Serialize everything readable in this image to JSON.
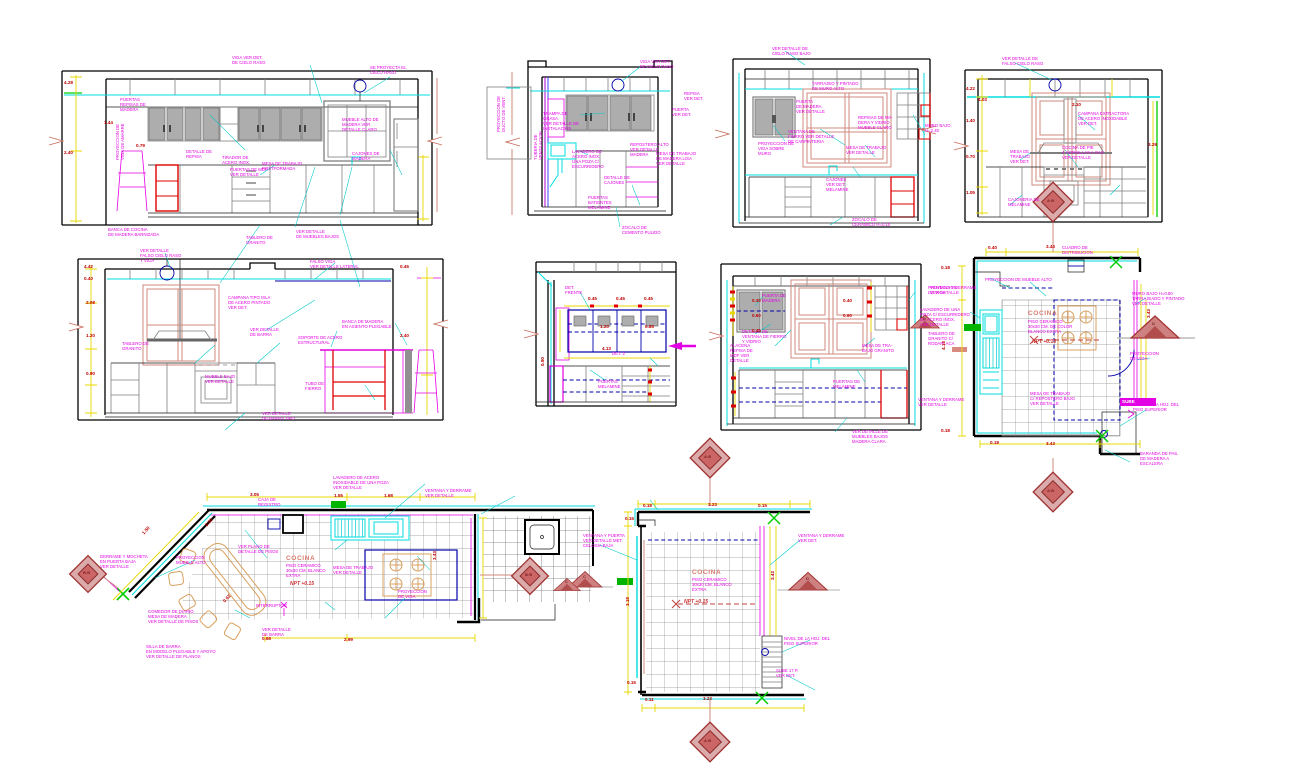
{
  "sheet": {
    "background": "#ffffff"
  },
  "colors": {
    "annotation": "#e400e4",
    "dimension": "#c00000",
    "linework_cyan": "#00dede",
    "dim_line_yellow": "#e8d800",
    "accent_red": "#e00000",
    "hidden_navy": "#0000a8",
    "window_salmon": "#d08a7e",
    "marker_darkred": "#a03030",
    "cabinet_gray": "#adadad",
    "green": "#00cc00",
    "stove_tan": "#d9a05f"
  },
  "annotations": [
    {
      "x": 232,
      "y": 56,
      "t": "VIGA VER DET.\nDE CIELO RASO"
    },
    {
      "x": 370,
      "y": 66,
      "t": "SE PROYECTA EL\nCIELO RASO"
    },
    {
      "x": 120,
      "y": 98,
      "t": "PUERTAS\nREPISAS DE\nMADERA"
    },
    {
      "x": 116,
      "y": 160,
      "r": -90,
      "t": "PROYECCION DE\nVIGA DE AMARRE"
    },
    {
      "x": 186,
      "y": 150,
      "t": "DETALLE DE\nREPISA"
    },
    {
      "x": 222,
      "y": 156,
      "t": "TIRADOR DE\nACERO INOX."
    },
    {
      "x": 230,
      "y": 168,
      "t": "PUERTAS DE MDF\nVER DETALLE"
    },
    {
      "x": 262,
      "y": 162,
      "t": "MESA DE TRABAJO\nPOSTFORMADA"
    },
    {
      "x": 352,
      "y": 152,
      "t": "CAJONES DE\nMADERA"
    },
    {
      "x": 342,
      "y": 118,
      "t": "MUEBLE ALTO DE\nMADERA VER\nDETALLE CLARO"
    },
    {
      "x": 108,
      "y": 228,
      "t": "BANCA DE COCINA\nDE MADERA BARNIZADA"
    },
    {
      "x": 296,
      "y": 230,
      "t": "VER DETALLE\nDE MUEBLES BAJOS"
    },
    {
      "x": 246,
      "y": 236,
      "t": "TABLERO DE\nGRANITO"
    },
    {
      "x": 64,
      "y": 80,
      "c": "d",
      "t": "4.28"
    },
    {
      "x": 64,
      "y": 150,
      "c": "d",
      "t": "2.40"
    },
    {
      "x": 136,
      "y": 143,
      "c": "d",
      "t": "0.79"
    },
    {
      "x": 104,
      "y": 120,
      "c": "d",
      "t": "1.44"
    },
    {
      "x": 640,
      "y": 60,
      "t": "VIGA VER DET.\nDE CIELO RASO"
    },
    {
      "x": 684,
      "y": 92,
      "t": "REPISA\nVER DET."
    },
    {
      "x": 543,
      "y": 112,
      "t": "TRAMPA DE\nGRASA\nVER DETALLE DE\nINSTALACION"
    },
    {
      "x": 672,
      "y": 108,
      "t": "PUERTA\nVER DET."
    },
    {
      "x": 572,
      "y": 150,
      "t": "LAVADERO DE\nACERO INOX.\nUNA POZA C/\nESCURRIDERO"
    },
    {
      "x": 630,
      "y": 143,
      "t": "REPOSTERO ALTO\nVER DETALLE\nMADERA"
    },
    {
      "x": 656,
      "y": 152,
      "t": "MESA DE TRABAJO\nDE MADERA LISA\nVER DETALLE"
    },
    {
      "x": 604,
      "y": 176,
      "t": "DETALLE DE\nCAJONES"
    },
    {
      "x": 588,
      "y": 196,
      "t": "PUERTAS\nBATIENTES\nMELAMINE"
    },
    {
      "x": 622,
      "y": 226,
      "t": "ZOCALO DE\nCEMENTO PULIDO"
    },
    {
      "x": 534,
      "y": 160,
      "r": -90,
      "t": "TUBERIA DE\nVENTILACION"
    },
    {
      "x": 772,
      "y": 47,
      "t": "VER DETALLE DE\nCIELO RASO BAJO"
    },
    {
      "x": 812,
      "y": 82,
      "t": "TARRAJEO Y PINTADO\nDE MURO ALTO"
    },
    {
      "x": 796,
      "y": 100,
      "t": "PUERTA\nDE MADERA\nVER DETALLE"
    },
    {
      "x": 858,
      "y": 116,
      "t": "REPISAS DE MA-\nDERA Y VIDRIO\nMUEBLE CLARO"
    },
    {
      "x": 788,
      "y": 130,
      "t": "VENTANA DE\nFIERRO VER DETALLE\nDE CARPINTERIA"
    },
    {
      "x": 758,
      "y": 142,
      "t": "PROYECCION DE\nVIGA SOBRE\nMURO"
    },
    {
      "x": 846,
      "y": 146,
      "t": "MESA DE TRABAJO\nVER DETALLE"
    },
    {
      "x": 826,
      "y": 178,
      "t": "CAJONES\nVER DET.\nMELAMINE"
    },
    {
      "x": 852,
      "y": 218,
      "t": "ZOCALO DE\nCERAMICO H=0.10"
    },
    {
      "x": 925,
      "y": 124,
      "t": "MURO BAJO\nH=2.40"
    },
    {
      "x": 1002,
      "y": 57,
      "t": "VER DETALLE DE\nFALSO CIELO RASO"
    },
    {
      "x": 1078,
      "y": 112,
      "t": "CAMPANA EXTRACTORA\nDE ACERO INOXIDABLE\nVER DET."
    },
    {
      "x": 1010,
      "y": 150,
      "t": "MESA DE\nTRABAJO\nVER DET."
    },
    {
      "x": 1062,
      "y": 146,
      "t": "COCINA DE PIE\n4 HORNILLAS A GAS\nVER DETALLE"
    },
    {
      "x": 1008,
      "y": 198,
      "t": "CAJONERIA DE\nMELAMINE"
    },
    {
      "x": 966,
      "y": 86,
      "c": "d",
      "t": "4.22"
    },
    {
      "x": 978,
      "y": 97,
      "c": "d",
      "t": "4.03"
    },
    {
      "x": 966,
      "y": 118,
      "c": "d",
      "t": "1.40"
    },
    {
      "x": 966,
      "y": 154,
      "c": "d",
      "t": "0.70"
    },
    {
      "x": 966,
      "y": 190,
      "c": "d",
      "t": "1.05"
    },
    {
      "x": 1072,
      "y": 102,
      "c": "d",
      "t": "2.10"
    },
    {
      "x": 1148,
      "y": 142,
      "c": "d",
      "t": "3.29"
    },
    {
      "x": 140,
      "y": 249,
      "t": "VER DETALLE\nFALSO CIELO RASO\nY VIGA"
    },
    {
      "x": 310,
      "y": 260,
      "t": "FALSO VIGA\nVER DETALLE LATERAL"
    },
    {
      "x": 228,
      "y": 296,
      "t": "CAMPANA TIPO ISLA\nDE ACERO PINTADO\nVER DET."
    },
    {
      "x": 250,
      "y": 328,
      "t": "VER DETALLE\nDE BARRA"
    },
    {
      "x": 298,
      "y": 336,
      "t": "SOPORTE DE ACERO\nESTRUCTURAL"
    },
    {
      "x": 342,
      "y": 320,
      "t": "BANCA DE MADERA\nEN ASIENTO PLEGABLE"
    },
    {
      "x": 122,
      "y": 342,
      "t": "TABLERO DE\nGRANITO"
    },
    {
      "x": 205,
      "y": 375,
      "t": "MUEBLE BAJO\nVER DETALLE"
    },
    {
      "x": 305,
      "y": 382,
      "t": "TUBO DE\nFIERRO"
    },
    {
      "x": 262,
      "y": 412,
      "t": "VER DETALLE\nDE BARRA TIPO"
    },
    {
      "x": 84,
      "y": 264,
      "c": "d",
      "t": "4.42"
    },
    {
      "x": 84,
      "y": 276,
      "c": "d",
      "t": "0.40"
    },
    {
      "x": 86,
      "y": 300,
      "c": "d",
      "t": "2.08"
    },
    {
      "x": 86,
      "y": 333,
      "c": "d",
      "t": "1.20"
    },
    {
      "x": 86,
      "y": 371,
      "c": "d",
      "t": "0.90"
    },
    {
      "x": 400,
      "y": 264,
      "c": "d",
      "t": "0.45"
    },
    {
      "x": 400,
      "y": 333,
      "c": "d",
      "t": "2.40"
    },
    {
      "x": 565,
      "y": 286,
      "t": "DET.\nFRENTE"
    },
    {
      "x": 612,
      "y": 352,
      "t": "DET. 2"
    },
    {
      "x": 598,
      "y": 380,
      "t": "PUERTAS\nMELAMINE"
    },
    {
      "x": 588,
      "y": 296,
      "c": "d",
      "t": "0.45"
    },
    {
      "x": 616,
      "y": 296,
      "c": "d",
      "t": "0.45"
    },
    {
      "x": 644,
      "y": 296,
      "c": "d",
      "t": "0.45"
    },
    {
      "x": 600,
      "y": 324,
      "c": "d",
      "t": "1.20"
    },
    {
      "x": 645,
      "y": 324,
      "c": "d",
      "t": "0.85"
    },
    {
      "x": 602,
      "y": 346,
      "c": "d",
      "t": "4.13"
    },
    {
      "x": 540,
      "y": 366,
      "r": -90,
      "c": "d",
      "t": "0.90"
    },
    {
      "x": 762,
      "y": 294,
      "t": "PUERTA DE\nMADERA"
    },
    {
      "x": 742,
      "y": 330,
      "t": "DETALLE DE\nVENTANA DE FIERRO\nY VIDRIO"
    },
    {
      "x": 730,
      "y": 344,
      "t": "ALACENA\nREPISA DE\nMDF VER\nDETALLE"
    },
    {
      "x": 862,
      "y": 344,
      "t": "MESA DE TRA-\nBAJO GRANITO"
    },
    {
      "x": 833,
      "y": 380,
      "t": "PUERTAS DE\nMELAMINE"
    },
    {
      "x": 852,
      "y": 430,
      "t": "VER DETALLE DE\nMUEBLES BAJOS\nMADERA CLARA"
    },
    {
      "x": 928,
      "y": 286,
      "t": "PROYECCION\nDE VIGA"
    },
    {
      "x": 928,
      "y": 332,
      "t": "TABLERO DE\nGRANITO C/\nRODAPLACA"
    },
    {
      "x": 752,
      "y": 298,
      "c": "d",
      "t": "0.30"
    },
    {
      "x": 752,
      "y": 313,
      "c": "d",
      "t": "0.60"
    },
    {
      "x": 752,
      "y": 328,
      "c": "d",
      "t": "0.45"
    },
    {
      "x": 843,
      "y": 298,
      "c": "d",
      "t": "0.40"
    },
    {
      "x": 843,
      "y": 313,
      "c": "d",
      "t": "0.60"
    },
    {
      "x": 1062,
      "y": 246,
      "t": "CUADRO DE\nDISTRIBUCION"
    },
    {
      "x": 985,
      "y": 278,
      "t": "PROYECCION DE MUEBLE ALTO"
    },
    {
      "x": 930,
      "y": 286,
      "t": "VENTANA Y DERRAME\nVER DETALLE"
    },
    {
      "x": 920,
      "y": 308,
      "t": "LAVADERO DE UNA\nPOZA C/ ESCURRIDERO\nDE ACERO INOX.\nVER DETALLE"
    },
    {
      "x": 1132,
      "y": 292,
      "t": "MURO BAJO H=0.80\nTARRAJEADO Y PINTADO\nVER DETALLE"
    },
    {
      "x": 1130,
      "y": 352,
      "t": "PROYECCION\nDE VIGA"
    },
    {
      "x": 1133,
      "y": 403,
      "t": "NIVEL DE LA HOJ. DEL\nPISO SUPERIOR"
    },
    {
      "x": 1122,
      "y": 399,
      "c": "w",
      "t": "SUBE"
    },
    {
      "x": 1140,
      "y": 452,
      "t": "BARANDA DE PAS.\nDE MADERA A\nESCALERA"
    },
    {
      "x": 1028,
      "y": 310,
      "c": "t",
      "t": "COCINA",
      "n": "plan-title"
    },
    {
      "x": 1028,
      "y": 320,
      "t": "PISO CERAMICO\n30x30 CM. DE COLOR\nBLANCO EXTRA"
    },
    {
      "x": 1032,
      "y": 340,
      "c": "np",
      "t": "NPT +0.15",
      "n": "level-label"
    },
    {
      "x": 1030,
      "y": 392,
      "t": "MESA DE TRABAJO\nC/ REPOSTERO BAJO\nVER DETALLE"
    },
    {
      "x": 918,
      "y": 398,
      "t": "VENTANA Y DERRAME\nVER DETALLE"
    },
    {
      "x": 988,
      "y": 245,
      "c": "d",
      "t": "0.40"
    },
    {
      "x": 1046,
      "y": 244,
      "c": "d",
      "t": "3.43"
    },
    {
      "x": 941,
      "y": 265,
      "c": "d",
      "t": "0.18"
    },
    {
      "x": 941,
      "y": 350,
      "r": -90,
      "c": "d",
      "t": "4.13"
    },
    {
      "x": 941,
      "y": 428,
      "c": "d",
      "t": "0.18"
    },
    {
      "x": 990,
      "y": 440,
      "c": "d",
      "t": "0.18"
    },
    {
      "x": 1046,
      "y": 441,
      "c": "d",
      "t": "3.43"
    },
    {
      "x": 1146,
      "y": 318,
      "r": -90,
      "c": "d",
      "t": "3.43"
    },
    {
      "x": 258,
      "y": 498,
      "t": "CAJA DE\nREGISTRO"
    },
    {
      "x": 333,
      "y": 476,
      "t": "LAVADERO DE ACERO\nINOXIDABLE DE UNA POZA\nVER DETALLE"
    },
    {
      "x": 425,
      "y": 489,
      "t": "VENTANA Y DERRAME\nVER DETALLE"
    },
    {
      "x": 100,
      "y": 555,
      "t": "DERRAME Y MOCHETA\nEN PUERTA BAJA\nVER DETALLE"
    },
    {
      "x": 176,
      "y": 556,
      "t": "PROYECCION\nMUEBLE ALTO"
    },
    {
      "x": 238,
      "y": 545,
      "t": "VER PLANO DE\nDETALLE DE PISOS"
    },
    {
      "x": 286,
      "y": 555,
      "c": "t",
      "t": "COCINA",
      "n": "plan-title"
    },
    {
      "x": 286,
      "y": 564,
      "t": "PISO CERAMICO\n30x30 CM. BLANCO\nEXTRA"
    },
    {
      "x": 290,
      "y": 582,
      "c": "np",
      "t": "NPT +0.15",
      "n": "level-label"
    },
    {
      "x": 333,
      "y": 566,
      "t": "MESA DE TRABAJO\nVER DETALLE"
    },
    {
      "x": 398,
      "y": 590,
      "t": "PROYECCION\nDE VIGA"
    },
    {
      "x": 256,
      "y": 604,
      "t": "INTERRUPTOR"
    },
    {
      "x": 148,
      "y": 610,
      "t": "COMEDOR DE DIARIO\nMESA DE MADERA\nVER DETALLE DE PISOS"
    },
    {
      "x": 146,
      "y": 645,
      "t": "SILLA DE BARRA\nEN MODELO PLEGABLE Y APOYO\nVER DETALLE DE PLANOS"
    },
    {
      "x": 262,
      "y": 628,
      "t": "VER DETALLE\nDE BARRA"
    },
    {
      "x": 250,
      "y": 492,
      "c": "d",
      "t": "3.05"
    },
    {
      "x": 334,
      "y": 493,
      "c": "d",
      "t": "1.55"
    },
    {
      "x": 384,
      "y": 493,
      "c": "d",
      "t": "1.68"
    },
    {
      "x": 141,
      "y": 532,
      "r": -47,
      "c": "d",
      "t": "1.50"
    },
    {
      "x": 204,
      "y": 524,
      "r": -47,
      "c": "d",
      "t": "0.90"
    },
    {
      "x": 222,
      "y": 600,
      "r": -47,
      "c": "d",
      "t": "0.62"
    },
    {
      "x": 262,
      "y": 636,
      "c": "d",
      "t": "0.68"
    },
    {
      "x": 344,
      "y": 637,
      "c": "d",
      "t": "2.99"
    },
    {
      "x": 432,
      "y": 560,
      "r": -90,
      "c": "d",
      "t": "3.43"
    },
    {
      "x": 583,
      "y": 534,
      "t": "VENTANA Y PUERTA\nVER DETALLE MET.\nCELOSIA BAJA"
    },
    {
      "x": 798,
      "y": 534,
      "t": "VENTANA Y DERRAME\nVER DET."
    },
    {
      "x": 692,
      "y": 569,
      "c": "t",
      "t": "COCINA",
      "n": "plan-title"
    },
    {
      "x": 692,
      "y": 578,
      "t": "PISO CERAMICO\n30x30 CM. BLANCO\nEXTRA"
    },
    {
      "x": 684,
      "y": 600,
      "c": "np",
      "t": "NPT +0.15",
      "n": "level-label"
    },
    {
      "x": 784,
      "y": 637,
      "t": "NIVEL DE LA HOJ. DEL\nPISO SUPERIOR"
    },
    {
      "x": 776,
      "y": 669,
      "t": "SUBE 17 P.\nVER DET."
    },
    {
      "x": 643,
      "y": 503,
      "c": "d",
      "t": "0.18"
    },
    {
      "x": 708,
      "y": 502,
      "c": "d",
      "t": "3.23"
    },
    {
      "x": 758,
      "y": 503,
      "c": "d",
      "t": "0.15"
    },
    {
      "x": 625,
      "y": 516,
      "c": "d",
      "t": "0.15"
    },
    {
      "x": 625,
      "y": 606,
      "r": -90,
      "c": "d",
      "t": "3.18"
    },
    {
      "x": 627,
      "y": 680,
      "c": "d",
      "t": "0.15"
    },
    {
      "x": 645,
      "y": 697,
      "c": "d",
      "t": "0.11"
    },
    {
      "x": 703,
      "y": 696,
      "c": "d",
      "t": "3.23"
    },
    {
      "x": 770,
      "y": 580,
      "r": -90,
      "c": "d",
      "t": "3.43"
    },
    {
      "x": 497,
      "y": 132,
      "r": -90,
      "t": "PROYECCION DE\nDUCTO DE VENT."
    },
    {
      "x": 1047,
      "y": 199,
      "c": "mk",
      "t": "A·B",
      "n": "marker-letter"
    },
    {
      "x": 1047,
      "y": 489,
      "c": "mk",
      "t": "A·B",
      "n": "marker-letter"
    },
    {
      "x": 704,
      "y": 455,
      "c": "mk",
      "t": "A·B",
      "n": "marker-letter"
    },
    {
      "x": 704,
      "y": 739,
      "c": "mk",
      "t": "A·B",
      "n": "marker-letter"
    },
    {
      "x": 83,
      "y": 571,
      "c": "mk",
      "t": "B·B",
      "n": "marker-letter"
    },
    {
      "x": 525,
      "y": 573,
      "c": "mk",
      "t": "B·B",
      "n": "marker-letter"
    },
    {
      "x": 1152,
      "y": 322,
      "c": "mk",
      "t": "D",
      "n": "marker-letter"
    },
    {
      "x": 583,
      "y": 575,
      "c": "mk",
      "t": "C",
      "n": "marker-letter"
    },
    {
      "x": 806,
      "y": 577,
      "c": "mk",
      "t": "D",
      "n": "marker-letter"
    },
    {
      "x": 565,
      "y": 580,
      "c": "mk",
      "t": "C",
      "n": "marker-letter"
    },
    {
      "x": 923,
      "y": 317,
      "c": "mk",
      "t": "D",
      "n": "marker-letter"
    }
  ]
}
